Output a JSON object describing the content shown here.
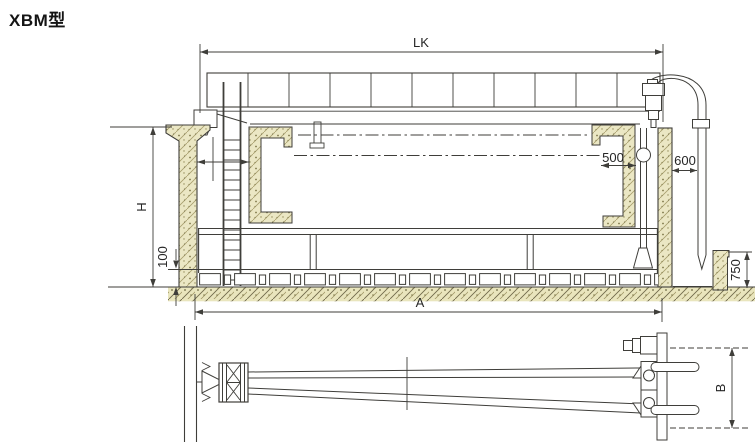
{
  "labels": {
    "model": "XBM型"
  },
  "dims": {
    "lk": "LK",
    "h": "H",
    "offset100": "100",
    "gap500": "500",
    "gap600": "600",
    "depth750": "750",
    "length_a": "A",
    "width_b": "B"
  },
  "colors": {
    "line": "#3f3e3a",
    "concrete_fill": "#ebe7c4",
    "background": "#ffffff"
  }
}
